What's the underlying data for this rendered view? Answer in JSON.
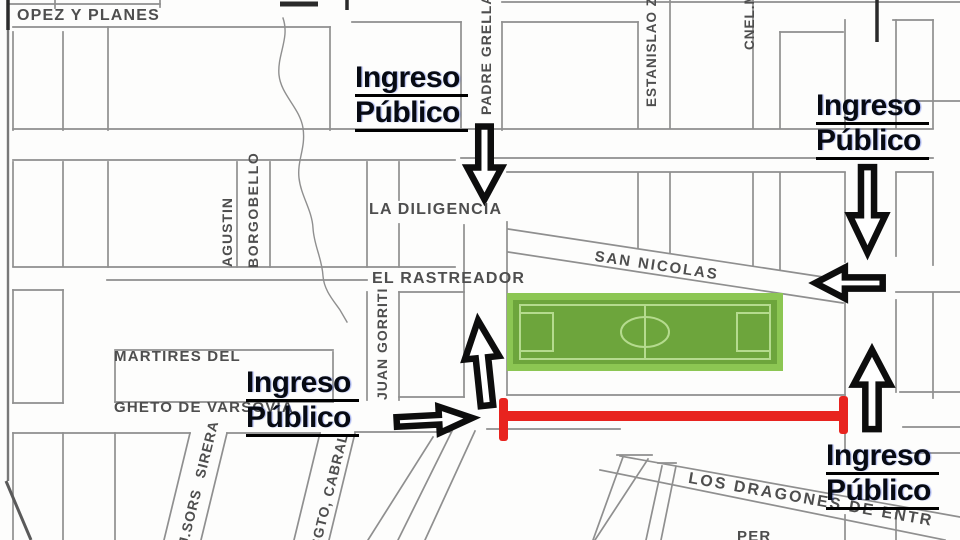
{
  "map": {
    "description": "street map of stadium surroundings with public entrance annotations",
    "colors": {
      "field_green_outer": "#8cc653",
      "field_green_inner": "#6da53c",
      "field_pitch_lines": "#b5db8e",
      "closed_street_red": "#e8241f",
      "street_line_gray": "#8f8f8f",
      "street_text_gray": "#4e4e4e",
      "annotation_black": "#0d0d0d"
    },
    "streets": {
      "lopez_y_planes": "OPEZ Y PLANES",
      "la_diligencia": "LA DILIGENCIA",
      "el_rastreador": "EL RASTREADOR",
      "san_nicolas": "SAN NICOLAS",
      "martires_line1": "MARTIRES DEL",
      "martires_line2": "GHETO DE VARSOVIA",
      "padre_grella": "PADRE GRELLA",
      "estanislao_zevallos": "ESTANISLAO ZEV",
      "cnel_m": "CNEL.M",
      "agustin": "AGUSTIN",
      "borgobello": "BORGOBELLO",
      "juan_gorriti": "JUAN GORRITI",
      "jsors_sirera": "J.SORS SIRERA",
      "sgto_cabral": "SGTO, CABRAL",
      "los_dragones": "LOS DRAGONES DE ENTR",
      "partial_bottom": "PER"
    },
    "entrances": [
      {
        "position": "top-center",
        "lines": [
          "Ingreso",
          "Público"
        ]
      },
      {
        "position": "top-right",
        "lines": [
          "Ingreso",
          "Público"
        ]
      },
      {
        "position": "center-left",
        "lines": [
          "Ingreso",
          "Público"
        ]
      },
      {
        "position": "bottom-right",
        "lines": [
          "Ingreso",
          "Público"
        ]
      }
    ],
    "arrows": [
      {
        "icon": "arrow-down-icon",
        "location": "top-center street"
      },
      {
        "icon": "arrow-down-icon",
        "location": "top-right street"
      },
      {
        "icon": "arrow-left-icon",
        "location": "san nicolas east end"
      },
      {
        "icon": "arrow-up-icon",
        "location": "west of field"
      },
      {
        "icon": "arrow-right-icon",
        "location": "center-left street"
      },
      {
        "icon": "arrow-up-icon",
        "location": "east of red closed street"
      }
    ],
    "landmarks": {
      "soccer_field": "green pitch with center circle and penalty boxes",
      "closed_street": "red bar with end caps along street south of field",
      "creek": "wavy line through north-west blocks"
    }
  }
}
